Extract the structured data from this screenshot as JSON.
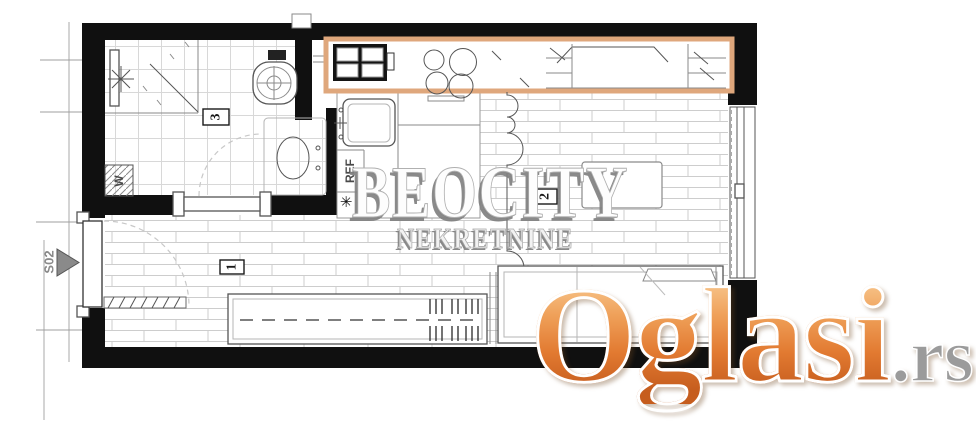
{
  "plan": {
    "section_marker": "S02",
    "room_numbers": {
      "hallway": "1",
      "living_room": "2",
      "bathroom": "3"
    },
    "appliances": {
      "washing_machine": "W",
      "fridge": "REF",
      "boiler": "✳"
    }
  },
  "watermark": {
    "brand": "BEOCITY",
    "subtitle": "NEKRETNINE"
  },
  "logo": {
    "name": "Oglasi",
    "tld": ".rs"
  },
  "colors": {
    "wall_black": "#101010",
    "cabinet_highlight_orange": "#dfa77c",
    "logo_orange": "#e27a31",
    "logo_tld_gray": "#9b9b9b",
    "watermark_gray": "#8f8f8f"
  }
}
